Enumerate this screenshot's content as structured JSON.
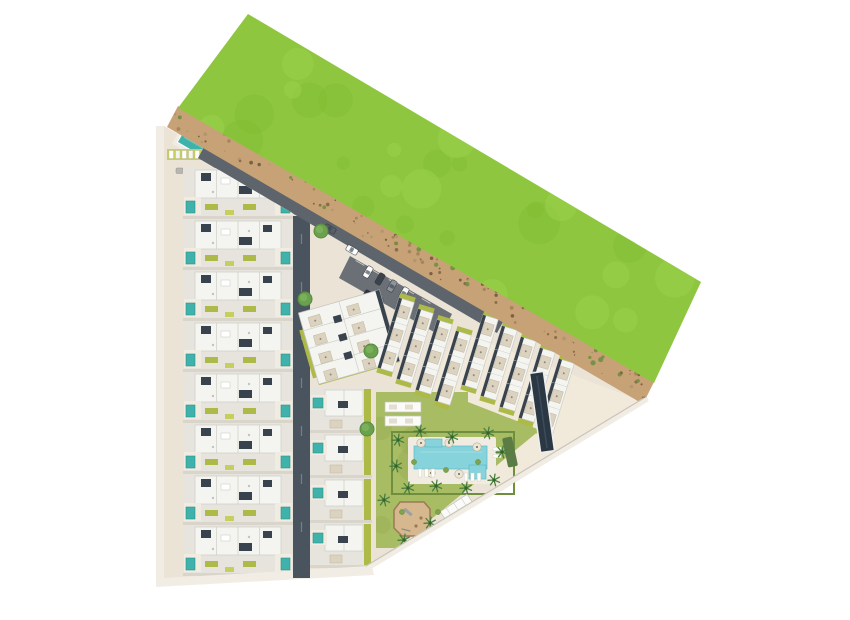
{
  "scene_type": "aerial-site-plan-render",
  "canvas": {
    "width": 850,
    "height": 620,
    "background": "#ffffff"
  },
  "palette": {
    "field": "#8ec63f",
    "field_blob_light": "#9bd14d",
    "field_blob_dark": "#7db832",
    "dirt": "#c7a277",
    "dirt_dark": "#8a6d4b",
    "dirt_mid": "#a6855a",
    "dirt_light": "#b5966c",
    "dirt_shrub": "#6b8e3e",
    "road": "#5d646c",
    "road_dark": "#49545f",
    "road_line": "#767f8a",
    "parking": "#6a7076",
    "stall": "#c9d86a",
    "site": "#eae3d6",
    "plaza": "#f1e9da",
    "sidewalk": "#f2ede4",
    "curb": "#c9c4ba",
    "path": "#d9d5cb",
    "roof_white": "#f4f4f1",
    "roof_line": "#cfcfc8",
    "roof_dark": "#39434d",
    "roof_base": "#e7e4dd",
    "pool_private": "#3fb3ab",
    "pool_private_edge": "#2e8f89",
    "pool_deck": "#f1ece1",
    "pool_main": "#86d3dc",
    "pool_main_edge": "#5fb9c6",
    "hedge": "#aeba48",
    "hedge_light": "#c6cf5e",
    "enclosure": "#6f8f3f",
    "lawn": "#a7bc63",
    "lawn_dark": "#98ad55",
    "terrace": "#dbd2c0",
    "terrace_edge": "#c2b69c",
    "playground": "#d7b78d",
    "playground_edge": "#9a7b57",
    "palm": "#4a7f3e",
    "palm_center": "#34632c",
    "tree": "#6aa04e",
    "tree_edge": "#578a40",
    "tree_light": "#7cb35d",
    "slab_dark": "#2b3743",
    "slab_edge": "#eef0ef",
    "pergola": "#fbfbf9",
    "pergola_edge": "#c7c4bb",
    "shrub_strip": "#5c7c46",
    "car_colors": [
      "#ffffff",
      "#3c434d",
      "#8d949c",
      "#f6f6f6",
      "#2e3640",
      "#aab0b6",
      "#ffffff",
      "#565e68"
    ]
  },
  "geometry": {
    "field_poly": "248,14 701,282 654,383 178,108",
    "dirt_poly": "178,106 654,382 643,404 167,127",
    "site_poly": "164,126 644,402 370,566 164,578",
    "sidewalk_left": [
      156,
      126,
      9,
      456
    ],
    "sidewalk_bottom_poly": "156,578 372,566 374,575 156,587",
    "boundary_line": [
      646,
      400,
      368,
      568
    ],
    "road_diag_poly": "204,147 503,322 497,333 198,158",
    "road_clip_poly": "156,133 497,333 497,620 156,620",
    "road_vert": [
      293,
      216,
      17,
      362
    ],
    "parking_poly": "350,256 452,314 441,336 339,278",
    "plaza_poly": "455,330 644,402 500,492 430,396",
    "lawn_poly": "376,392 468,392 468,402 540,430 396,548 376,548",
    "enclosure_rect": [
      392,
      432,
      122,
      62
    ],
    "pool_deck_rect": [
      408,
      437,
      88,
      47
    ],
    "pool_rects": [
      [
        414,
        446,
        73,
        23
      ],
      [
        469,
        465,
        17,
        14
      ],
      [
        425,
        439,
        17,
        8
      ]
    ],
    "playground_poly": "400,502 424,502 430,509 430,529 423,536 402,536 394,528 394,510",
    "slab_building": {
      "x": 542,
      "y": 412,
      "rot": -8,
      "w": 14,
      "h": 80
    },
    "shrub_strip": {
      "x": 510,
      "y": 452,
      "rot": -12,
      "w": 10,
      "h": 30
    },
    "pergola_rot": {
      "x": 457,
      "y": 508,
      "rot": -33,
      "w": 32,
      "h": 12
    },
    "amenity_pool": {
      "x": 197,
      "y": 146,
      "rot": 30,
      "w": 38,
      "h": 13
    },
    "amenity_lounger_band": [
      167,
      149,
      48,
      11
    ],
    "mid_cluster": {
      "x": 349,
      "y": 337,
      "rot": -16,
      "w": 84,
      "h": 74
    }
  },
  "buildings": {
    "townhouse_column": {
      "x": 183,
      "w": 110,
      "y0": 168,
      "row_h": 51,
      "rows": 8
    },
    "inner_column": {
      "x": 310,
      "w": 62,
      "y0": 388,
      "row_h": 45,
      "rows": 4
    },
    "mid_cluster_units": 8,
    "row_groups": [
      {
        "rot": 17,
        "centers": [
          [
            396,
            335
          ],
          [
            415,
            346
          ],
          [
            434,
            357
          ],
          [
            453,
            368
          ]
        ]
      },
      {
        "rot": 17,
        "centers": [
          [
            480,
            352
          ],
          [
            499,
            363
          ],
          [
            518,
            374
          ],
          [
            537,
            385
          ],
          [
            556,
            396
          ]
        ]
      }
    ],
    "narrow_building": {
      "w": 16,
      "h": 73,
      "terraces": 3
    }
  },
  "vehicles": [
    {
      "x": 368,
      "y": 272,
      "rot": -60,
      "c": 0
    },
    {
      "x": 380,
      "y": 279,
      "rot": -60,
      "c": 1
    },
    {
      "x": 392,
      "y": 286,
      "rot": -60,
      "c": 2
    },
    {
      "x": 404,
      "y": 293,
      "rot": -60,
      "c": 3
    },
    {
      "x": 366,
      "y": 296,
      "rot": -60,
      "c": 4
    },
    {
      "x": 378,
      "y": 303,
      "rot": -60,
      "c": 5
    },
    {
      "x": 352,
      "y": 250,
      "rot": 30,
      "c": 6
    },
    {
      "x": 330,
      "y": 229,
      "rot": 30,
      "c": 7
    }
  ],
  "garden": {
    "umbrellas": [
      [
        421,
        443
      ],
      [
        449,
        443
      ],
      [
        477,
        447
      ],
      [
        431,
        473
      ],
      [
        459,
        474
      ]
    ],
    "loungers": [
      {
        "x": 466,
        "y": 477,
        "dx": 6.5,
        "dy": 0,
        "n": 3,
        "rot": 0
      },
      {
        "x": 420,
        "y": 473,
        "dx": 6.5,
        "dy": 0,
        "n": 3,
        "rot": 0
      },
      {
        "x": 497,
        "y": 449,
        "dx": 0,
        "dy": 7,
        "n": 2,
        "rot": 90
      }
    ],
    "palms": [
      [
        398,
        440
      ],
      [
        396,
        466
      ],
      [
        408,
        488
      ],
      [
        436,
        486
      ],
      [
        466,
        488
      ],
      [
        494,
        480
      ],
      [
        502,
        452
      ],
      [
        488,
        433
      ],
      [
        452,
        437
      ],
      [
        420,
        431
      ],
      [
        384,
        500
      ],
      [
        404,
        540
      ],
      [
        430,
        523
      ]
    ],
    "bushes": [
      [
        414,
        462
      ],
      [
        446,
        470
      ],
      [
        478,
        462
      ],
      [
        402,
        512
      ],
      [
        438,
        512
      ]
    ],
    "pergolas": [
      [
        385,
        402,
        36,
        10
      ],
      [
        385,
        416,
        36,
        10
      ]
    ],
    "trees": [
      [
        321,
        231
      ],
      [
        305,
        299
      ],
      [
        371,
        351
      ],
      [
        367,
        429
      ]
    ]
  },
  "texture": {
    "field_blobs": 26,
    "dirt_speckles": 85,
    "dirt_shrubs": 16,
    "lawn_blobs": 8
  }
}
